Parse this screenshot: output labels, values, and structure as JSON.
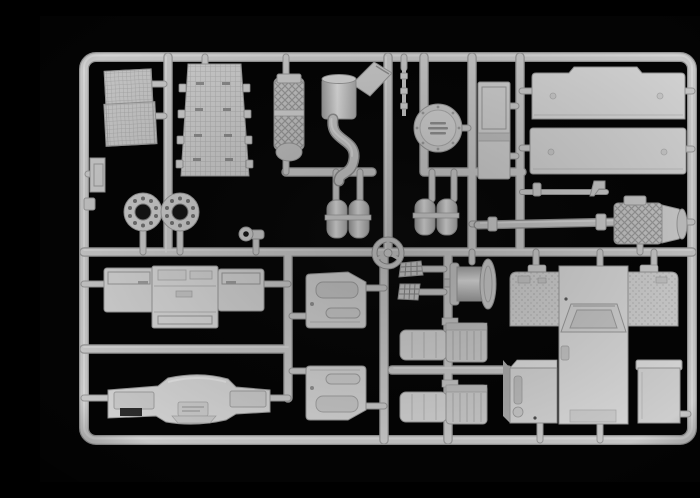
{
  "image": {
    "description": "Photograph of a light gray injection-molded plastic model kit sprue (parts tree) for a truck model, on a black background",
    "background": "#040404"
  },
  "colors": {
    "bg": "#040404",
    "plastic": "#c6c6c6",
    "plastic-hi": "#dfdfdf",
    "plastic-lo": "#969696",
    "plastic-mid": "#cfcfcf",
    "hole": "#141414"
  },
  "parts": [
    {
      "name": "sprue-frame",
      "label": "Outer sprue frame with rounded corners"
    },
    {
      "name": "runner-grid",
      "label": "Internal runner channels"
    },
    {
      "name": "radiator-grille-panel",
      "label": "Meshed radiator grille panel (top left)"
    },
    {
      "name": "canvas-mesh-panel",
      "label": "Tapered textured panel with side tabs"
    },
    {
      "name": "air-filter-part",
      "label": "Cross-hatched air filter canister"
    },
    {
      "name": "exhaust-stack-part",
      "label": "Exhaust stack cylinder with angled duct"
    },
    {
      "name": "exhaust-pipe-part",
      "label": "S-curved exhaust down pipe"
    },
    {
      "name": "fuel-line-rod",
      "label": "Thin rod with collar fittings"
    },
    {
      "name": "spare-wheel-cover-disc",
      "label": "Round hub / tank end cover disc"
    },
    {
      "name": "side-step-panel",
      "label": "Tall rectangular side panel"
    },
    {
      "name": "roof-panel-top",
      "label": "Large roof panel with notched edge (top right)"
    },
    {
      "name": "roof-panel-bottom",
      "label": "Second large rectangular roof panel"
    },
    {
      "name": "wheel-hub-flange-left",
      "label": "Bolted wheel hub flange disc"
    },
    {
      "name": "wheel-hub-flange-right",
      "label": "Bolted wheel hub flange disc"
    },
    {
      "name": "mirror-bracket-small",
      "label": "Small bracket on left rail"
    },
    {
      "name": "tow-hook-part",
      "label": "Small tow ring with stem"
    },
    {
      "name": "air-tank-pair-left",
      "label": "Pair of cylindrical air tanks"
    },
    {
      "name": "air-tank-pair-right",
      "label": "Pair of cylindrical air tanks"
    },
    {
      "name": "steering-wheel-part",
      "label": "Steering wheel with three spokes"
    },
    {
      "name": "pedal-grid-upper",
      "label": "Small grated step plate"
    },
    {
      "name": "pedal-grid-lower",
      "label": "Small grated step plate"
    },
    {
      "name": "winch-drum-part",
      "label": "Winch drum with flanges"
    },
    {
      "name": "gearbox-driveshaft-part",
      "label": "Long driveshaft with cross-hatched gearbox and bell housing"
    },
    {
      "name": "cab-front-panel",
      "label": "Cab front / rear wall panel assembly with wings"
    },
    {
      "name": "door-inner-panel-upper",
      "label": "Door inner panel with window pocket and armrest"
    },
    {
      "name": "door-inner-panel-lower",
      "label": "Mirrored door inner panel"
    },
    {
      "name": "seat-upper",
      "label": "Seat with ribbed backrest"
    },
    {
      "name": "seat-lower",
      "label": "Seat with ribbed backrest"
    },
    {
      "name": "engine-tunnel-assembly",
      "label": "Large cab floor / engine tunnel part with textured wings"
    },
    {
      "name": "battery-box-left",
      "label": "Battery / equipment box with slot and cap"
    },
    {
      "name": "battery-box-right",
      "label": "Battery / equipment box"
    },
    {
      "name": "bumper-dashboard-part",
      "label": "Wide bumper / dashboard part with center bulge"
    }
  ]
}
